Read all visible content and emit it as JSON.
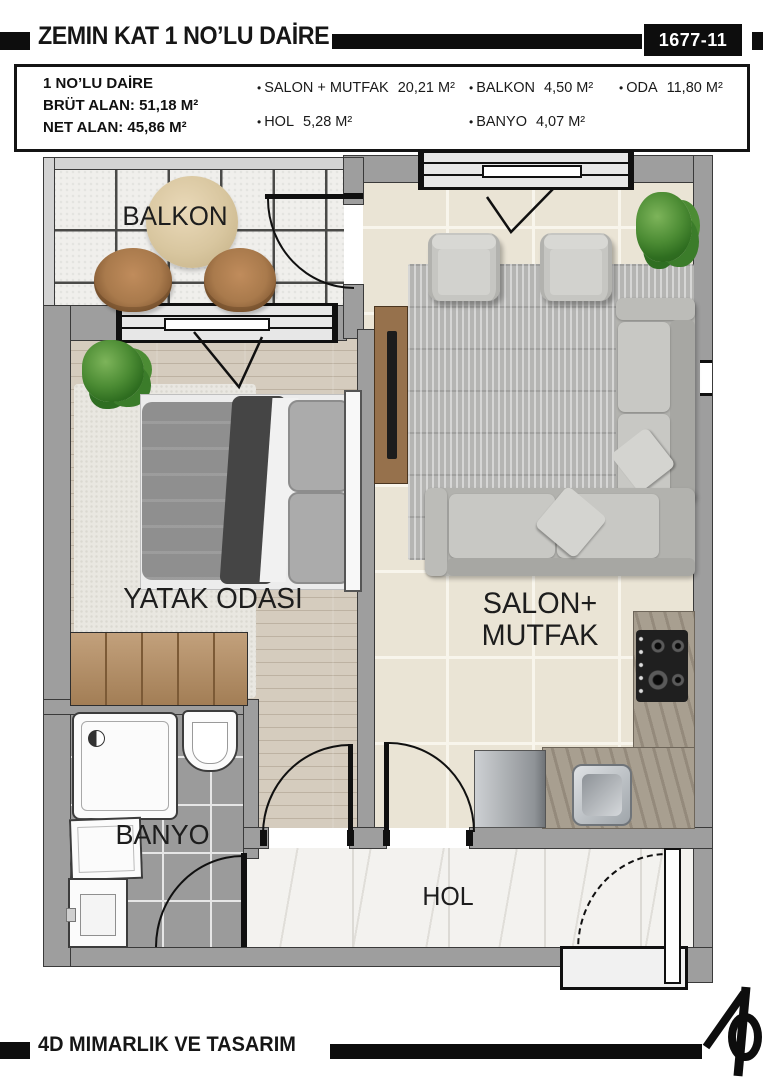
{
  "header": {
    "title": "ZEMIN KAT 1 NO’LU DAİRE",
    "plan_number": "1677-11"
  },
  "info_box": {
    "apartment_title": "1 NO’LU DAİRE",
    "gross_area": "BRÜT ALAN: 51,18 M²",
    "net_area": "NET ALAN: 45,86 M²",
    "areas": [
      {
        "label": "SALON + MUTFAK",
        "value": "20,21 M²"
      },
      {
        "label": "BALKON",
        "value": "4,50 M²"
      },
      {
        "label": "ODA",
        "value": "11,80 M²"
      },
      {
        "label": "HOL",
        "value": "5,28 M²"
      },
      {
        "label": "BANYO",
        "value": "4,07 M²"
      }
    ]
  },
  "rooms": {
    "balkon": "BALKON",
    "yatak_odasi": "YATAK ODASI",
    "salon_line1": "SALON+",
    "salon_line2": "MUTFAK",
    "banyo": "BANYO",
    "hol": "HOL"
  },
  "footer": {
    "company": "4D MIMARLIK VE TASARIM"
  },
  "palette": {
    "wall": "#9e9e9e",
    "wood_floor": "#cfc6b7",
    "salon_tile": "#eae4d5",
    "bath_tile": "#9b9b9b",
    "hall_marble": "#f3f2ef",
    "balcony_tile": "#f0efec",
    "plant_green": "#4c8c34",
    "counter_stone": "#a89f90",
    "ink": "#101010"
  }
}
